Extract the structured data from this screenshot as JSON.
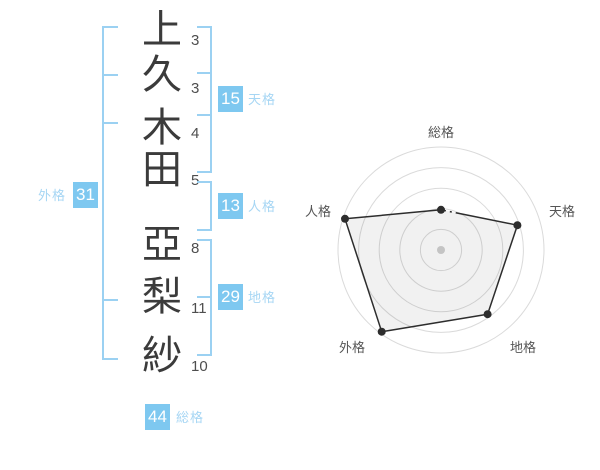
{
  "name_analysis": {
    "characters": [
      {
        "char": "上",
        "strokes": "3"
      },
      {
        "char": "久",
        "strokes": "3"
      },
      {
        "char": "木",
        "strokes": "4"
      },
      {
        "char": "田",
        "strokes": "5"
      },
      {
        "char": "亞",
        "strokes": "8"
      },
      {
        "char": "梨",
        "strokes": "11"
      },
      {
        "char": "紗",
        "strokes": "10"
      }
    ],
    "groups": {
      "tenkaku": {
        "label": "天格",
        "value": "15"
      },
      "jinkaku": {
        "label": "人格",
        "value": "13"
      },
      "chikaku": {
        "label": "地格",
        "value": "29"
      },
      "gaikaku": {
        "label": "外格",
        "value": "31"
      },
      "soukaku": {
        "label": "総格",
        "value": "44"
      }
    }
  },
  "colors": {
    "badge_blue": "#7ec8f0",
    "label_blue": "#a6d6f4",
    "bracket_blue": "#9bd1f2",
    "kanji_dark": "#3b3b3b",
    "grid_gray": "#dadada",
    "polygon_stroke": "#2d2d2d",
    "center_dot_gray": "#c4c4c4",
    "axis_label_gray": "#555555"
  },
  "chart_data": {
    "type": "radar",
    "title": "",
    "axes": [
      "総格",
      "天格",
      "地格",
      "外格",
      "人格"
    ],
    "values": [
      39,
      78,
      77,
      98,
      98
    ],
    "max": 100,
    "rings": 5,
    "grid": "concentric-circles",
    "legend": "none",
    "center_marker": true,
    "fill": "translucent-gray",
    "first_edge_style": "dashed-then-solid"
  }
}
